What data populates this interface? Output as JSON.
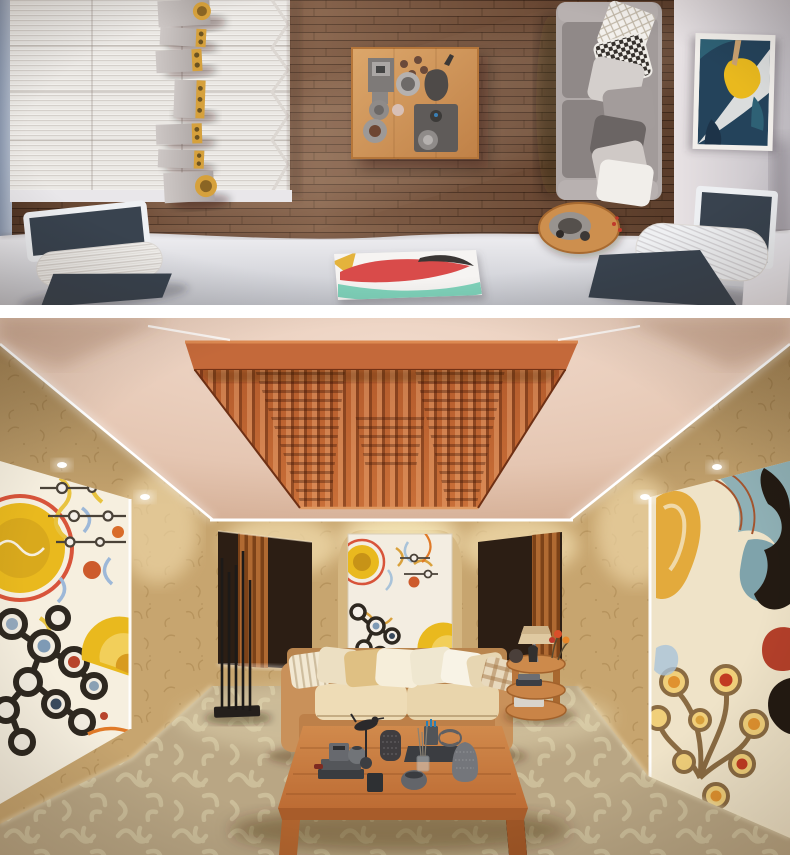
{
  "scene": {
    "title": "Listening room interior renders",
    "views": [
      {
        "id": "top-view",
        "label": "Top-down plan view of listening room with speaker column, coffee table, gray sofa and lounge chairs"
      },
      {
        "id": "perspective-view",
        "label": "Perspective view of listening room with ceiling diffuser, abstract wall paintings, leather sofa and coffee table"
      }
    ]
  },
  "palette": {
    "page_bg": "#ffffff",
    "wood_floor": "#74503a",
    "wood_plank_dark": "#5c3f2b",
    "left_wall_blue": "#9aa6b9",
    "diffuser_white": "#f1efec",
    "speaker_gray": "#c2bbb9",
    "speaker_gold": "#d39a3c",
    "table_wood_top": "#d09659",
    "sofa_gray": "#a8a1a0",
    "sofa_seat_gray": "#8e8786",
    "pillow_check_dark": "#35302c",
    "navy": "#39434f",
    "floor_white": "#e9e8ec",
    "art_navy": "#24435b",
    "art_yellow": "#e9b91e",
    "canvas_red": "#d94b4a",
    "canvas_teal": "#7fd2ba",
    "ceiling": "#ead0bf",
    "ceiling_edge": "#d2ab90",
    "led": "#ffffff",
    "diffuser_orange": "#c56a38",
    "diffuser_orange_dark": "#8a3f1c",
    "wall": "#c7a56f",
    "wall_pattern": "#a8854f",
    "panel_dark": "#2c1e14",
    "slat_orange": "#b06a32",
    "tapestry_bg": "#f3ede1",
    "sofa_tan": "#c68f55",
    "cushion_cream": "#eedcb6",
    "carpet": "#c6b391",
    "carpet_squiggle": "#e0d2ae",
    "coffee_table_wood": "#c57a3f",
    "decor_gray": "#5f6165",
    "lamp_shade": "#dfc9a1",
    "painting_left_bg": "#f6efdf",
    "painting_right_bg": "#efe3c8",
    "art_black": "#2e2820",
    "art_orange": "#e07a28",
    "art_teal_wave": "#7fa3ab"
  },
  "top_view_objects": [
    "blue-gray-side-wall",
    "white-acoustic-diffuser",
    "speaker-column-7-speakers",
    "wood-plank-floor",
    "coffee-table-with-decor",
    "gray-sofa-with-pillows",
    "round-wood-side-table",
    "abstract-wall-painting",
    "white-lounge-chair-left",
    "white-lounge-chair-right",
    "flat-abstract-canvas",
    "white-floor-band"
  ],
  "perspective_view_objects": [
    "peach-ceiling-with-led-strips",
    "wood-ceiling-diffuser",
    "recessed-downlights",
    "damask-wallpaper-walls",
    "left-abstract-painting",
    "right-abstract-painting",
    "center-tapestry-art",
    "dark-acoustic-panel-left",
    "dark-acoustic-panel-right",
    "black-rod-floor-lamp",
    "tan-leather-sofa-with-pillows",
    "three-tier-side-table-with-lamp",
    "wood-coffee-table-with-gray-decor",
    "patterned-beige-carpet"
  ]
}
